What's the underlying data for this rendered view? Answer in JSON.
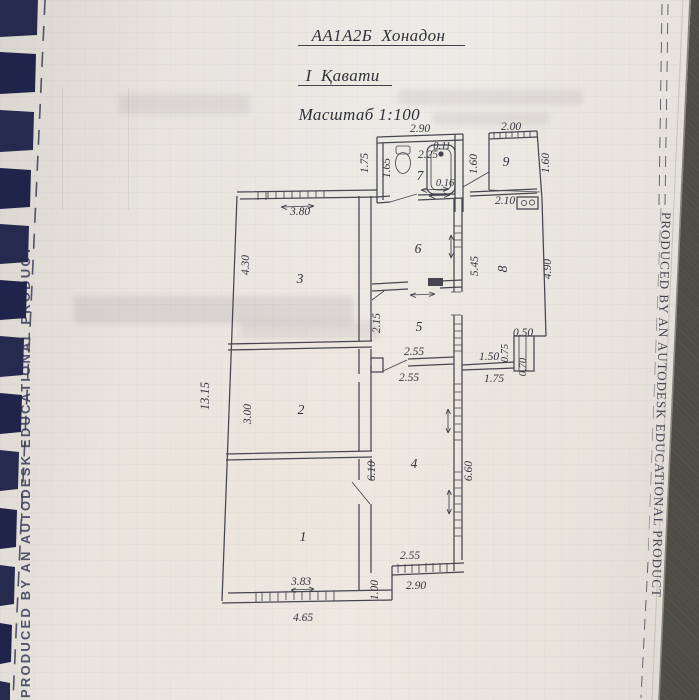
{
  "title": {
    "line1": "АА1А2Б  Хонадон",
    "line2": "I  Қавати",
    "line3": "Масштаб 1:100"
  },
  "banner": {
    "text": "PRODUCED BY AN AUTODESK EDUCATIONAL PRODUCT"
  },
  "plan": {
    "room_labels": [
      "1",
      "2",
      "3",
      "4",
      "5",
      "6",
      "7",
      "8",
      "9"
    ],
    "dims": {
      "top_bath": "2.90",
      "top_porch": "2.00",
      "tub_width": "0.11",
      "toilet_side": "2.25",
      "tub_bottom": "0.16",
      "bath_out_h": "1.75",
      "bath_in_h": "1.65",
      "porch_left_h": "1.60",
      "porch_right_h": "1.60",
      "counter": "2.10",
      "kitchen_left_h": "5.45",
      "kitchen_right_h": "4.90",
      "duct_top": "0.50",
      "duct_left": "0.75",
      "duct_right": "0.70",
      "ledge_top": "1.50",
      "ledge_bottom": "1.75",
      "hall_top_w": "2.55",
      "hall_top_w2": "2.55",
      "room5_h": "2.15",
      "total_left_h": "13.15",
      "room3_w": "3.80",
      "room3_h": "4.30",
      "room2_h": "3.00",
      "hall_left_h": "6.10",
      "hall_right_h": "6.60",
      "room1_win": "3.83",
      "room1_out_w": "4.65",
      "step_h": "1.00",
      "bot_win_in": "2.55",
      "bot_win_out": "2.90"
    }
  }
}
